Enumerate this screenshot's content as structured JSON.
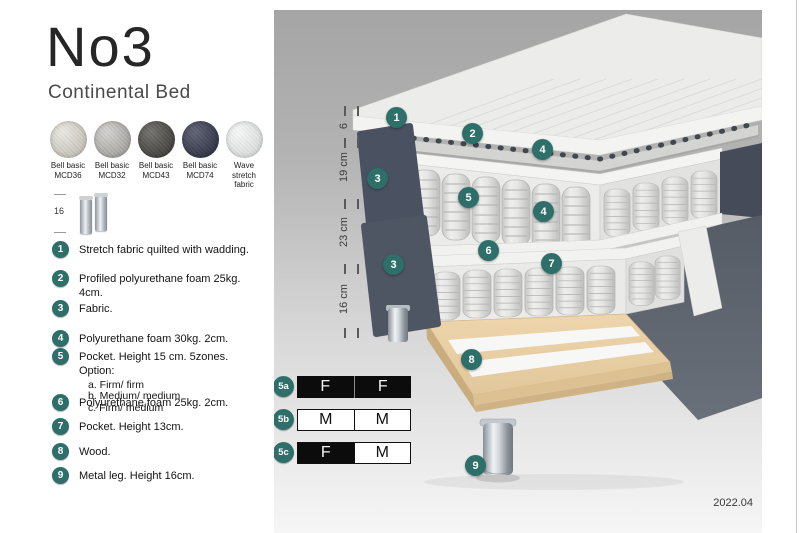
{
  "header": {
    "title": "No3",
    "subtitle": "Continental Bed"
  },
  "swatches": [
    {
      "line1": "Bell basic",
      "line2": "MCD36",
      "color": "#d6d2c8"
    },
    {
      "line1": "Bell basic",
      "line2": "MCD32",
      "color": "#b4b3af"
    },
    {
      "line1": "Bell basic",
      "line2": "MCD43",
      "color": "#4c4b47"
    },
    {
      "line1": "Bell basic",
      "line2": "MCD74",
      "color": "#3a3f55"
    },
    {
      "line1": "Wave",
      "line2": "stretch fabric",
      "color": "#e9ebeb"
    }
  ],
  "leg_thumbnail": {
    "height_label": "16"
  },
  "legend": [
    {
      "num": "1",
      "text": "Stretch fabric quilted with wadding."
    },
    {
      "num": "2",
      "text": "Profiled polyurethane foam 25kg. 4cm."
    },
    {
      "num": "3",
      "text": "Fabric."
    },
    {
      "num": "4",
      "text": "Polyurethane foam 30kg. 2cm."
    },
    {
      "num": "5",
      "text": "Pocket. Height 15 cm. 5zones. Option:",
      "options": [
        "a. Firm/ firm",
        "b. Medium/ medium",
        "c. Firm/ medium"
      ]
    },
    {
      "num": "6",
      "text": "Polyurethane foam 25kg. 2cm."
    },
    {
      "num": "7",
      "text": "Pocket. Height 13cm."
    },
    {
      "num": "8",
      "text": "Wood."
    },
    {
      "num": "9",
      "text": "Metal leg. Height 16cm."
    }
  ],
  "diagram": {
    "accent_color": "#2e6f6a",
    "ruler_labels": [
      "6",
      "19 cm",
      "23 cm",
      "16 cm"
    ],
    "callouts": {
      "c1": "1",
      "c2": "2",
      "c3a": "3",
      "c3b": "3",
      "c4a": "4",
      "c4b": "4",
      "c5": "5",
      "c6": "6",
      "c7": "7",
      "c8": "8",
      "c9": "9"
    },
    "firmness_rows": [
      {
        "id": "5a",
        "cells": [
          {
            "label": "F",
            "style": "dark"
          },
          {
            "label": "F",
            "style": "dark"
          }
        ]
      },
      {
        "id": "5b",
        "cells": [
          {
            "label": "M",
            "style": "light"
          },
          {
            "label": "M",
            "style": "light"
          }
        ]
      },
      {
        "id": "5c",
        "cells": [
          {
            "label": "F",
            "style": "dark"
          },
          {
            "label": "M",
            "style": "light"
          }
        ]
      }
    ],
    "version": "2022.04"
  }
}
